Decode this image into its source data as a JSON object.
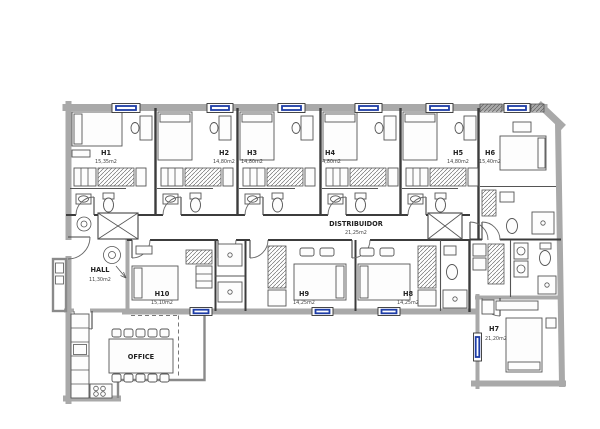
{
  "plan_type": "apartment-floor-plan",
  "colors": {
    "window": "#1d3ca6",
    "wall": "#a9a9a9",
    "line": "#3c3c3c"
  },
  "rooms": [
    {
      "id": "h1",
      "name": "H1",
      "area": "15,35m2"
    },
    {
      "id": "h2",
      "name": "H2",
      "area": "14,80m2"
    },
    {
      "id": "h3",
      "name": "H3",
      "area": "14,80m2"
    },
    {
      "id": "h4",
      "name": "H4",
      "area": "14,80m2"
    },
    {
      "id": "h5",
      "name": "H5",
      "area": "14,80m2"
    },
    {
      "id": "h6",
      "name": "H6",
      "area": "15,40m2"
    },
    {
      "id": "h7",
      "name": "H7",
      "area": "21,20m2"
    },
    {
      "id": "h8",
      "name": "H8",
      "area": "14,25m2"
    },
    {
      "id": "h9",
      "name": "H9",
      "area": "14,25m2"
    },
    {
      "id": "h10",
      "name": "H10",
      "area": "15,10m2"
    },
    {
      "id": "hall",
      "name": "HALL",
      "area": "11,30m2"
    },
    {
      "id": "distribuidor",
      "name": "DISTRIBUIDOR",
      "area": "21,25m2"
    },
    {
      "id": "office",
      "name": "OFFICE",
      "area": ""
    }
  ]
}
